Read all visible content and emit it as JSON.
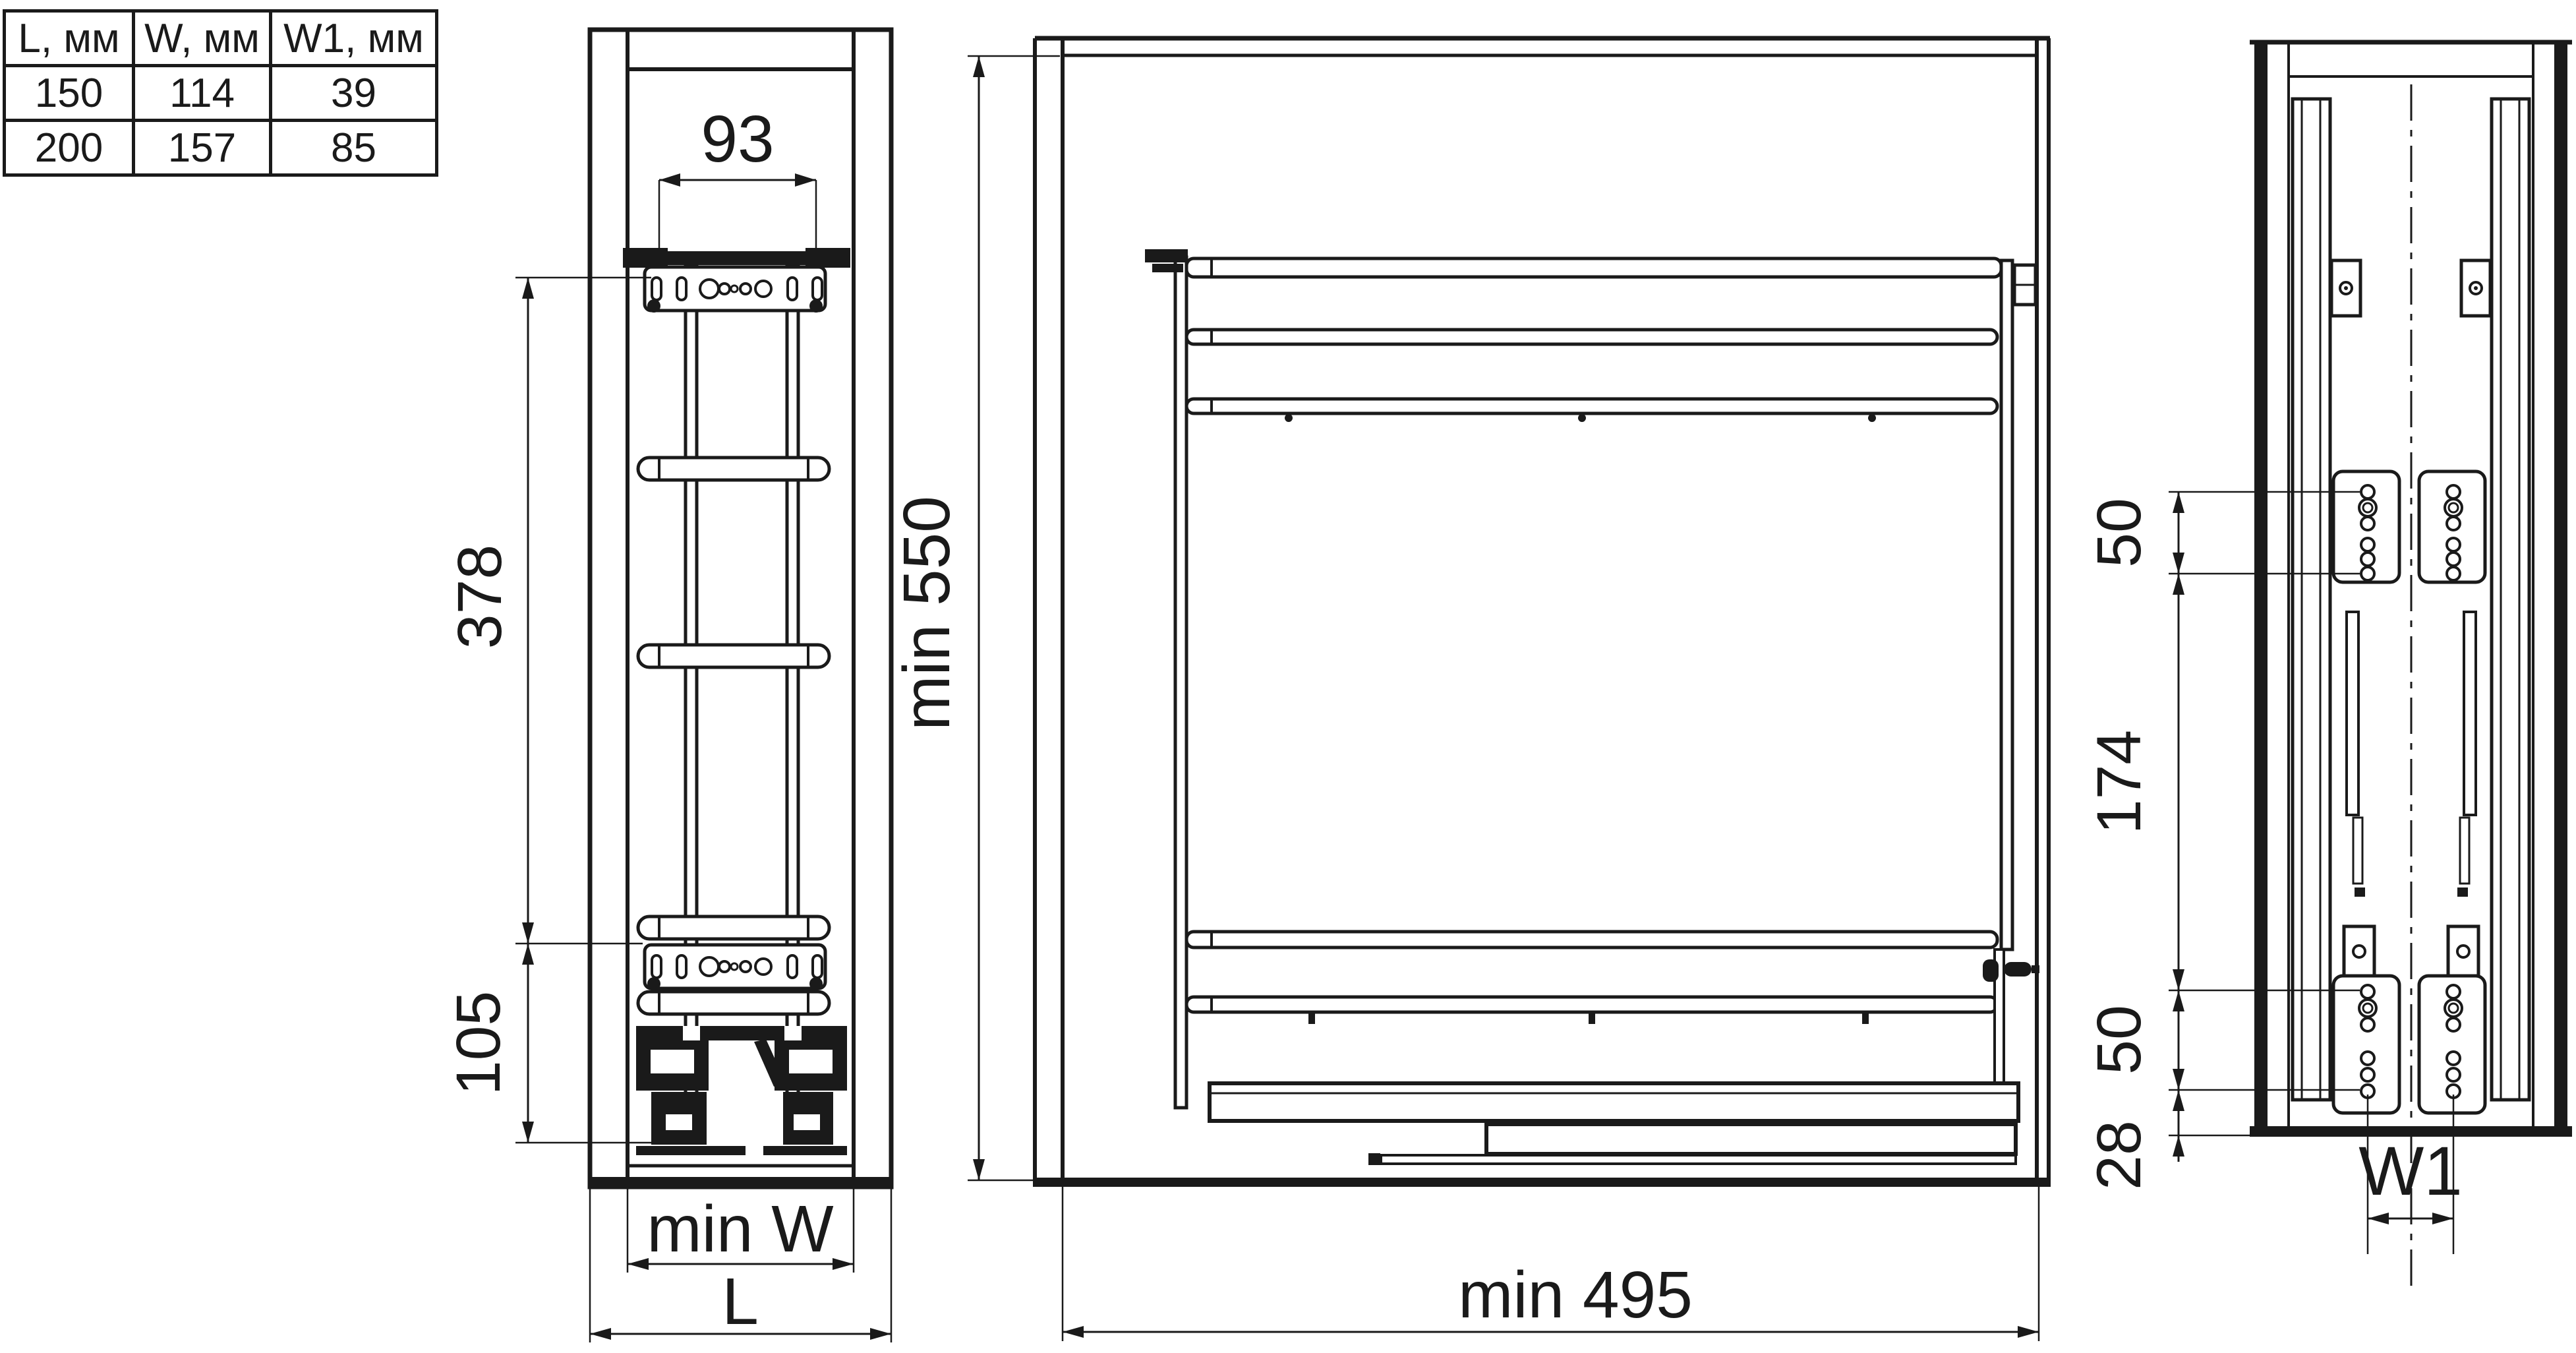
{
  "colors": {
    "line": "#1a1a1a",
    "background": "#ffffff"
  },
  "table": {
    "headers": [
      "L, мм",
      "W, мм",
      "W1, мм"
    ],
    "rows": [
      [
        "150",
        "114",
        "39"
      ],
      [
        "200",
        "157",
        "85"
      ]
    ]
  },
  "front_view": {
    "dim_bracket_width": "93",
    "dim_upper_height": "378",
    "dim_lower_height": "105",
    "dim_inner_width": "min W",
    "dim_outer_width": "L"
  },
  "side_view": {
    "dim_min_height": "min 550",
    "dim_min_depth": "min 495"
  },
  "back_view": {
    "dim_upper_holes": "50",
    "dim_mid_span": "174",
    "dim_lower_holes": "50",
    "dim_bottom_offset": "28",
    "dim_hole_distance": "W1"
  }
}
